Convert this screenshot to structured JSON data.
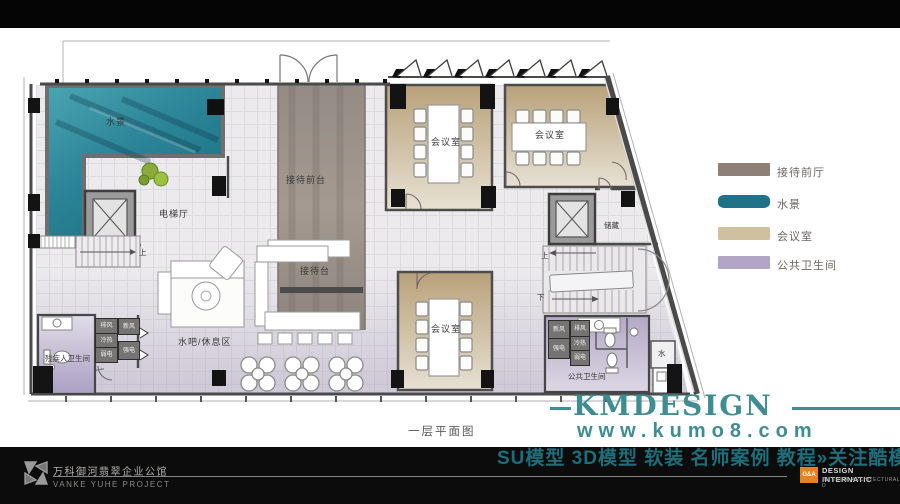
{
  "plan": {
    "title": "一层平面图",
    "labels": {
      "water": "水景",
      "elevator_hall": "电梯厅",
      "reception_hall": "接待前台",
      "reception_desk": "接待台",
      "meeting_room_1": "会议室",
      "meeting_room_2": "会议室",
      "meeting_room_3": "会议室",
      "storage": "储藏",
      "public_wc": "公共卫生间",
      "accessible_wc": "残疾人卫生间",
      "water_bar": "水吧/休息区",
      "water_room": "水",
      "stair_up_left": "上",
      "stair_up_right": "上",
      "stair_down_right": "下"
    },
    "mech_left": [
      "排风",
      "新风",
      "冷热",
      "弱电",
      "强电"
    ],
    "mech_right": [
      "新风",
      "排风",
      "冷热",
      "强电",
      "弱电"
    ]
  },
  "legend": {
    "items": [
      {
        "label": "接待前厅",
        "color": "#8d8177"
      },
      {
        "label": "水景",
        "color": "#1f7389"
      },
      {
        "label": "会议室",
        "color": "#cfc0a0"
      },
      {
        "label": "公共卫生间",
        "color": "#b1a6c6"
      }
    ]
  },
  "branding": {
    "logo_text": "KMDESIGN",
    "website": "www.kumo8.com",
    "promo": "SU模型 3D模型 软装 名师案例 教程»关注酷模吧",
    "accent_color": "#3f8d92",
    "promo_color": "#1d6e7a"
  },
  "footer": {
    "project_cn": "万科御河翡翠企业公馆",
    "project_en": "VANKE YUHE  PROJECT",
    "ga_badge": "G&A",
    "ga_badge_color": "#e8821e",
    "ga_line1": "DESIGN INTERNATIC",
    "ga_line2": "INTERIOR ARCHITECTURAL D"
  }
}
